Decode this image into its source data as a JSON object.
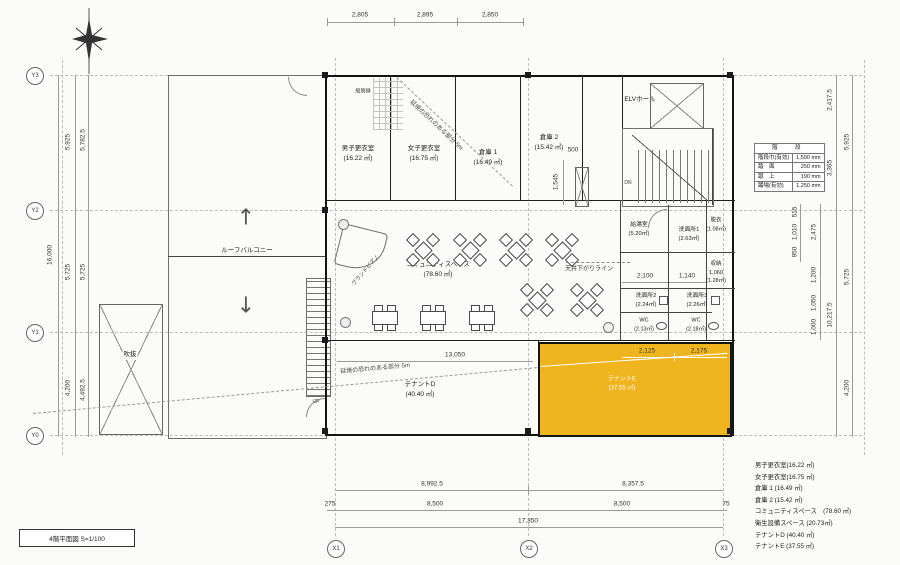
{
  "title_block": {
    "label": "4階平面図  S=1/100"
  },
  "grid": {
    "y": [
      "Y3",
      "Y2",
      "Y1",
      "Y0"
    ],
    "x": [
      "X1",
      "X2",
      "X3"
    ]
  },
  "dims": {
    "top": [
      "2,805",
      "2,895",
      "2,850"
    ],
    "left": {
      "total": "16,000",
      "outer": [
        "5,925",
        "5,725",
        "4,200"
      ],
      "inner": [
        "5,782.5",
        "5,725",
        "4,492.5"
      ]
    },
    "right": {
      "outer": [
        "5,925",
        "5,725",
        "4,200"
      ],
      "inner": [
        "2,417.5",
        "3,365",
        "10,217.5"
      ],
      "detail": [
        "515",
        "1,010",
        "950",
        "2,475",
        "1,200",
        "1,050",
        "1,000"
      ]
    },
    "bottom": {
      "row1": [
        "8,992.5",
        "8,357.5"
      ],
      "row2": [
        "275",
        "8,500",
        "8,500",
        "75"
      ],
      "total": "17,350"
    },
    "inner": {
      "d13050": "13,050",
      "d2125": "2,125",
      "d2175": "2,175",
      "d2100": "2,100",
      "d1140": "1,140",
      "d1060": "1,060",
      "d500": "500",
      "d1545": "1,545"
    }
  },
  "rooms": {
    "mens_locker": {
      "name": "男子更衣室",
      "area": "(16.22 ㎡)"
    },
    "womens_locker": {
      "name": "女子更衣室",
      "area": "(16.75 ㎡)"
    },
    "storage1": {
      "name": "倉庫 1",
      "area": "(16.49 ㎡)"
    },
    "storage2": {
      "name": "倉庫 2",
      "area": "(15.42 ㎡)"
    },
    "elv_hall": {
      "name": "ELVホール"
    },
    "roof_balcony": {
      "name": "ルーフバルコニー"
    },
    "void": {
      "name": "吹抜"
    },
    "community": {
      "name": "コミュニティスペース",
      "area": "(78.60 ㎡)"
    },
    "kitchenette": {
      "name": "給湯室",
      "area": "(5.20㎡)"
    },
    "washroom1": {
      "name": "洗面所1",
      "area": "(2.63㎡)"
    },
    "dressing": {
      "name": "脱衣",
      "area": "(1.08㎡)"
    },
    "closet": {
      "name": "収納",
      "area": "(1.28㎡)"
    },
    "washroom2": {
      "name": "洗面所2",
      "area": "(2.24㎡)"
    },
    "washroom3": {
      "name": "洗面所3",
      "area": "(2.26㎡)"
    },
    "wc1": {
      "name": "WC",
      "area": "(2.13㎡)"
    },
    "wc2": {
      "name": "WC",
      "area": "(2.18㎡)"
    },
    "tenant_d": {
      "name": "テナントD",
      "area": "(40.40 ㎡)"
    },
    "tenant_e": {
      "name": "テナントE",
      "area": "(37.55 ㎡)"
    },
    "piano": {
      "name": "グランドピアノ"
    }
  },
  "annotations": {
    "ceiling": "天井下がりライン",
    "fire_top": "延焼の恐れのある部分 5m",
    "fire_bottom": "延焼の恐れのある部分 5m",
    "downspout": "縦雨樋",
    "up": "UP",
    "dn": "DN"
  },
  "stair_table": {
    "header": "階　段",
    "rows": [
      {
        "k": "階段巾(有効)",
        "v": "1,500 mm"
      },
      {
        "k": "踏　面",
        "v": "250 mm"
      },
      {
        "k": "蹴　上",
        "v": "190 mm"
      },
      {
        "k": "踊場(有効)",
        "v": "1,250 mm"
      }
    ]
  },
  "legend": [
    "男子更衣室(16.22 ㎡)",
    "女子更衣室(16.75 ㎡)",
    "倉庫 1 (16.49 ㎡)",
    "倉庫 2 (15.42 ㎡)",
    "コミュニティスペース　(78.60 ㎡)",
    "衛生設備スペース (20.73㎡)",
    "テナントD (40.40 ㎡)",
    "テナントE (37.55 ㎡)"
  ],
  "colors": {
    "highlight": "#f0b41e"
  }
}
